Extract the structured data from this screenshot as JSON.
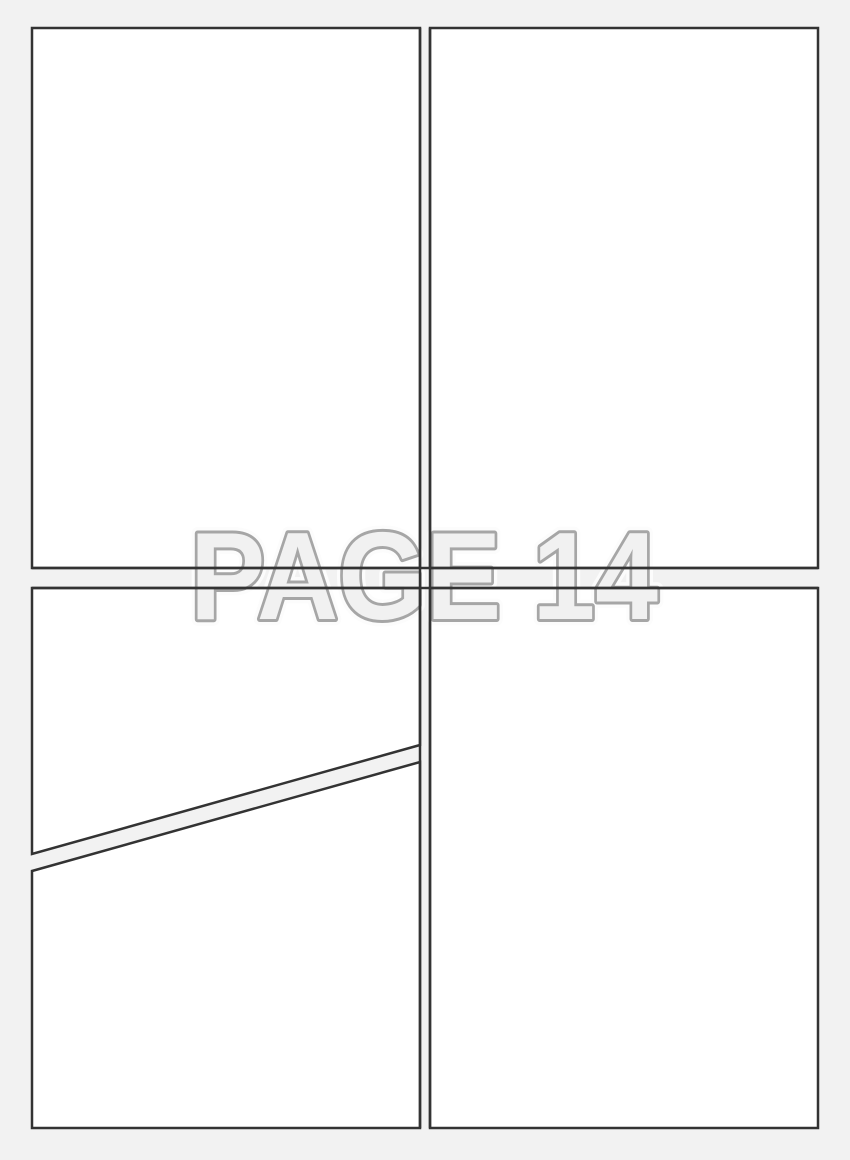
{
  "watermark": {
    "text": "PAGE 14"
  },
  "panels": {
    "count": 5,
    "names": [
      "top-left-panel",
      "top-right-panel",
      "bottom-left-upper-diagonal-panel",
      "bottom-left-lower-diagonal-panel",
      "bottom-right-panel"
    ]
  },
  "colors": {
    "background": "#f2f2f2",
    "panel_fill": "#ffffff",
    "panel_border": "#333333",
    "watermark_fill": "#f1f1f1",
    "watermark_outline": "#a6a6a6",
    "watermark_halo": "#fcfcfc"
  }
}
